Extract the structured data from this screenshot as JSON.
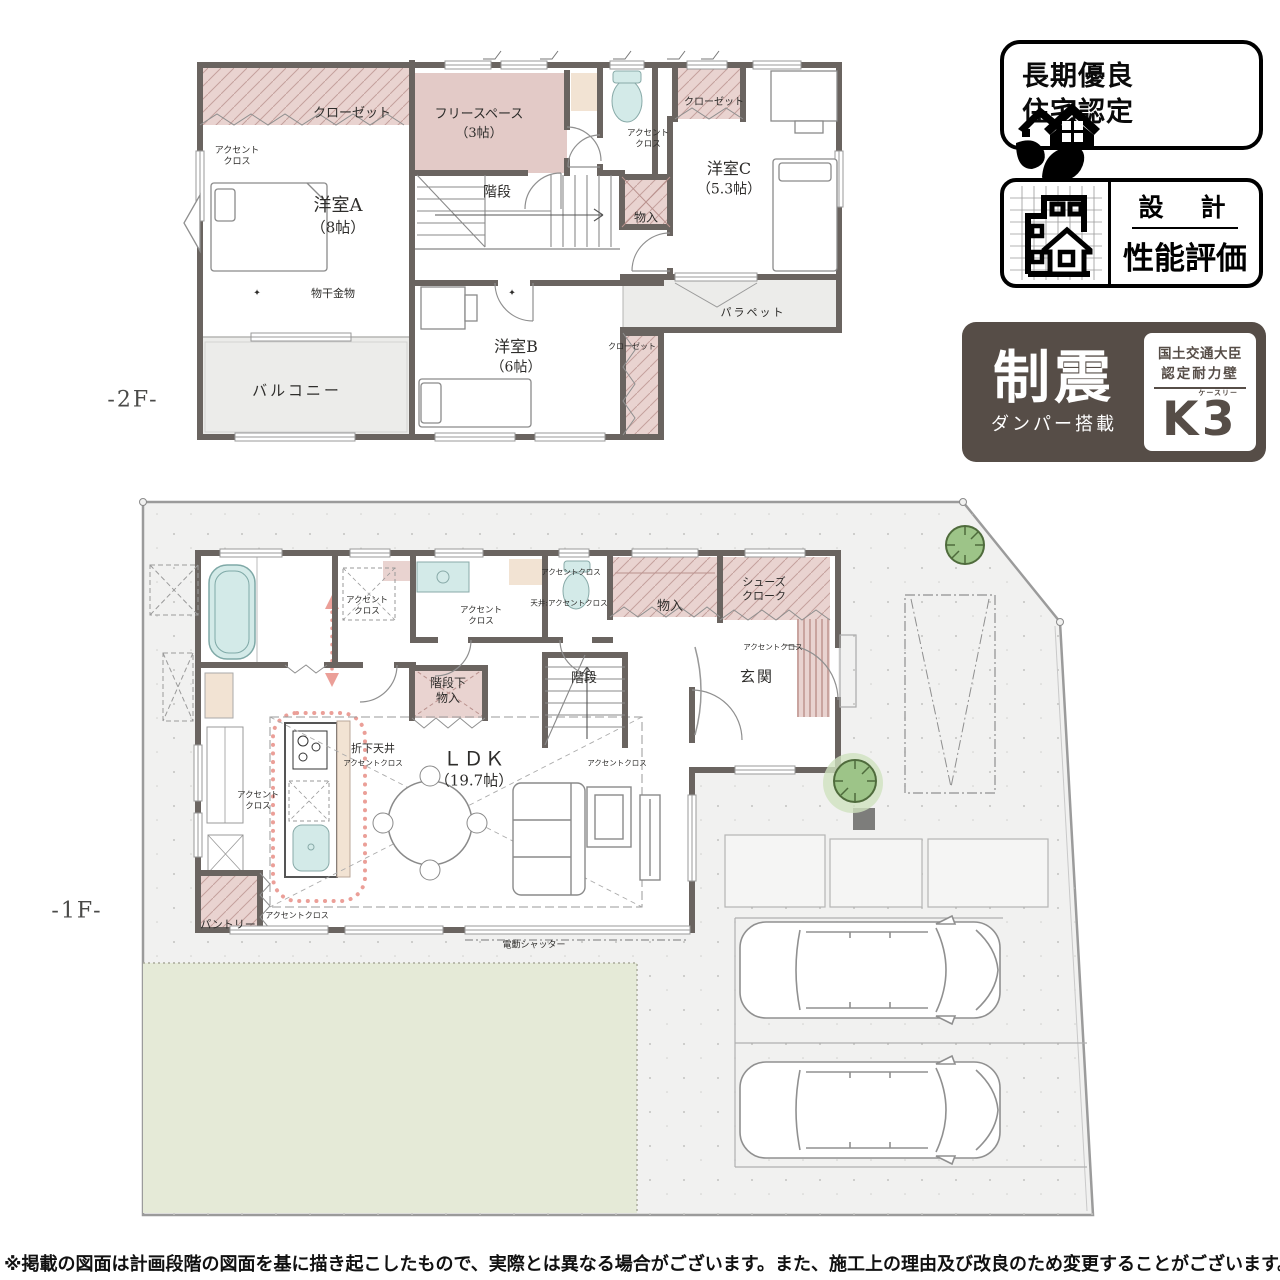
{
  "page": {
    "floor2_label": "-2F-",
    "floor1_label": "-1F-",
    "disclaimer": "※掲載の図面は計画段階の図面を基に描き起こしたもので、実際とは異なる場合がございます。また、施工上の理由及び改良のため変更することがございます。"
  },
  "plan2f": {
    "closet_a": "クローゼット",
    "accent_a": "アクセント\nクロス",
    "room_a_name": "洋室A",
    "room_a_size": "（8帖）",
    "monohoshi": "物干金物",
    "diamond": "✦",
    "balcony": "バルコニー",
    "free_space_name": "フリースペース",
    "free_space_size": "（3帖）",
    "stairs": "階段",
    "accent_wc": "アクセント\nクロス",
    "closet_c": "クローゼット",
    "room_c_name": "洋室C",
    "room_c_size": "（5.3帖）",
    "mono_in": "物入",
    "parapet": "パラペット",
    "room_b_name": "洋室B",
    "room_b_size": "（6帖）",
    "closet_b": "クローゼット"
  },
  "plan1f": {
    "accent_wash": "アクセント\nクロス",
    "accent_vanity": "アクセント\nクロス",
    "accent_wc": "アクセントクロス",
    "ceiling_accent": "天井:アクセントクロス",
    "mono_in": "物入",
    "shoes_cloak": "シューズ\nクローク",
    "accent_genkan": "アクセントクロス",
    "genkan": "玄関",
    "stairs": "階段",
    "stairs_storage": "階段下\n物入",
    "orishita": "折下天井",
    "orishita_sub": "アクセントクロス",
    "ldk_name": "ＬＤＫ",
    "ldk_size": "（19.7帖）",
    "accent_sofa": "アクセントクロス",
    "accent_left": "アクセント\nクロス",
    "accent_kitchen_bottom": "アクセントクロス",
    "pantry": "パントリー",
    "shutter": "電動シャッター"
  },
  "badges": {
    "choki_line1": "長期優良",
    "choki_line2": "住宅認定",
    "sekkei_top": "設　計",
    "sekkei_bottom": "性能評価",
    "seishin_big": "制震",
    "seishin_sub": "ダンパー搭載",
    "mlit_line1": "国土交通大臣",
    "mlit_line2": "認定耐力壁",
    "k3_k": "K",
    "k3_3": "3",
    "k3_kana": "ケースリー"
  }
}
